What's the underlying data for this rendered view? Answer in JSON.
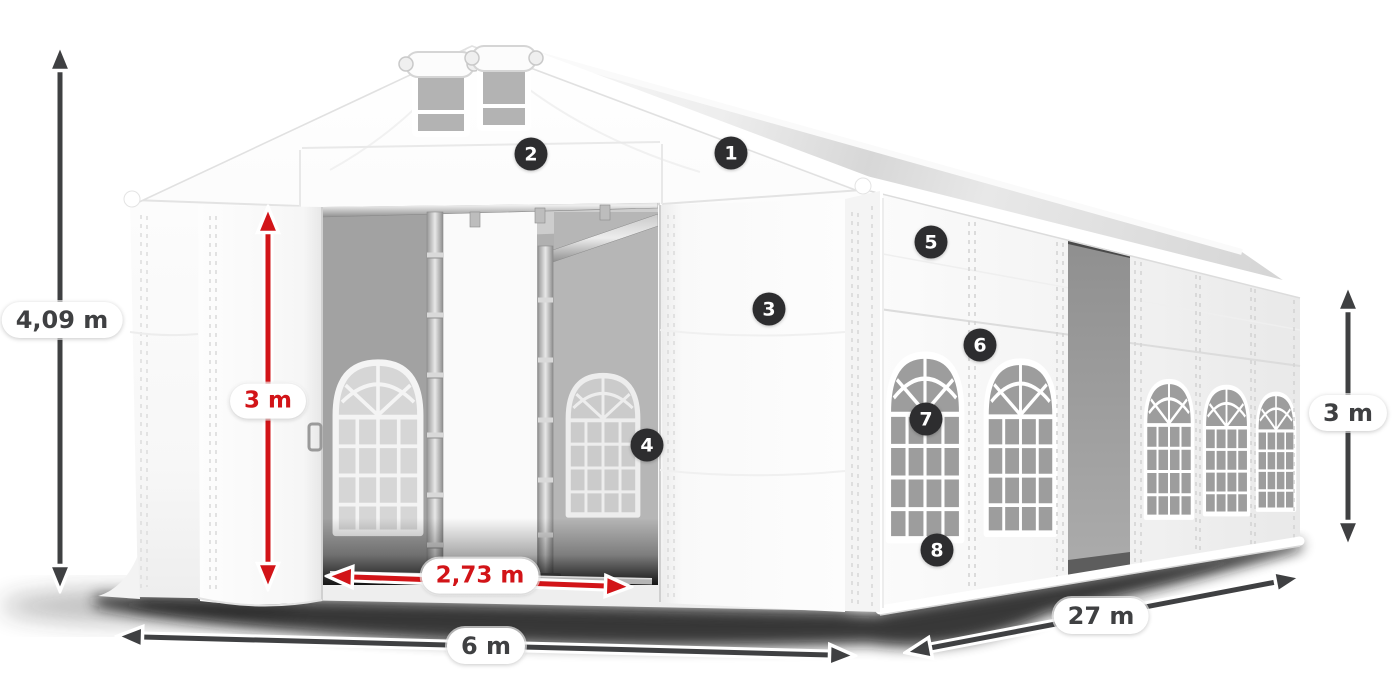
{
  "diagram": {
    "dimension_labels": {
      "total_height": "4,09 m",
      "entrance_height": "3 m",
      "entrance_width": "2,73 m",
      "span_width": "6 m",
      "length": "27 m",
      "side_wall_height": "3 m"
    },
    "callouts": [
      {
        "number": "1"
      },
      {
        "number": "2"
      },
      {
        "number": "3"
      },
      {
        "number": "4"
      },
      {
        "number": "5"
      },
      {
        "number": "6"
      },
      {
        "number": "7"
      },
      {
        "number": "8"
      }
    ],
    "colors": {
      "dimension_dark": "#3f4042",
      "dimension_red": "#d21418",
      "callout_background": "#2d2d2f",
      "label_background": "#ffffff",
      "tent_white": "#ffffff",
      "interior_gray": "#aeaeae"
    }
  }
}
